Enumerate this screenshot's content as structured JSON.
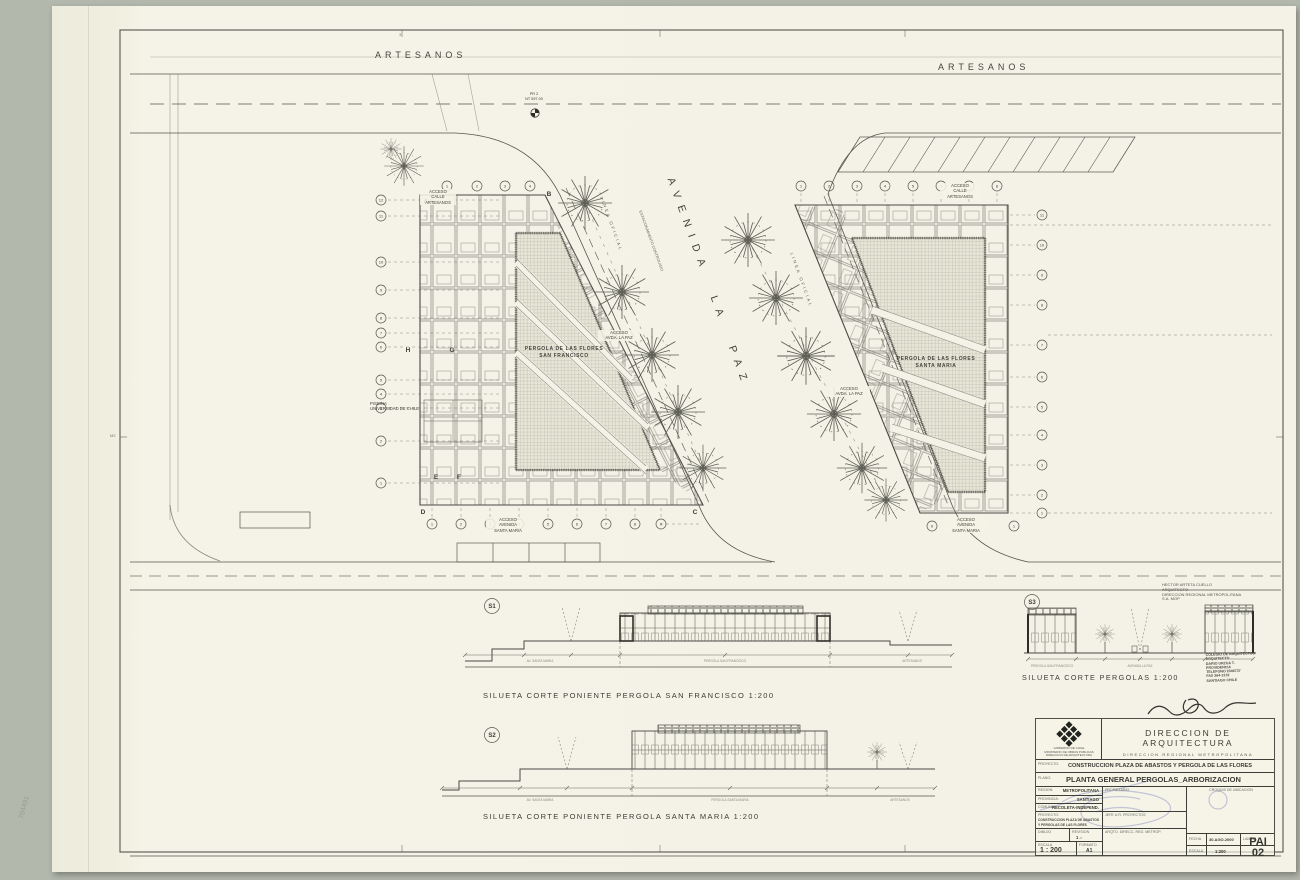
{
  "sheet": {
    "lamina_code": "PAI",
    "lamina_num": "02",
    "fold_mark": "3",
    "margin_mark": "M2",
    "corner_note": "784491"
  },
  "plan": {
    "street_top_left": "ARTESANOS",
    "street_top_right": "ARTESANOS",
    "avenue": "AVENIDA LA PAZ",
    "linea_oficial": "LINEA OFICIAL",
    "parking_note": "ESTACIONAMIENTO CONTROLADO",
    "survey": [
      "PR 2",
      "NT 597.00"
    ],
    "piscina": [
      "PISCINA",
      "UNIVERSIDAD DE CHILE"
    ],
    "left": {
      "name": [
        "PERGOLA DE LAS FLORES",
        "SAN FRANCISCO"
      ],
      "acceso_top": [
        "ACCESO",
        "CALLE",
        "ARTESANOS"
      ],
      "acceso_paz": [
        "ACCESO",
        "AVDA. LA PAZ"
      ],
      "acceso_bottom": [
        "ACCESO",
        "AVENIDA",
        "SANTA MARIA"
      ],
      "grid_letters": [
        "A",
        "B",
        "C",
        "D",
        "E",
        "F",
        "G",
        "H"
      ],
      "top_axes": [
        "1",
        "2",
        "3",
        "4"
      ],
      "bottom_axes": [
        "1",
        "2",
        "3",
        "4",
        "5",
        "6",
        "7",
        "8",
        "9"
      ],
      "side_axes": [
        "12",
        "11",
        "10",
        "9",
        "8",
        "7",
        "6",
        "5",
        "4",
        "3",
        "2",
        "1"
      ]
    },
    "right": {
      "name": [
        "PERGOLA DE LAS FLORES",
        "SANTA MARIA"
      ],
      "acceso_top": [
        "ACCESO",
        "CALLE",
        "ARTESANOS"
      ],
      "acceso_paz": [
        "ACCESO",
        "AVDA. LA PAZ"
      ],
      "acceso_bottom": [
        "ACCESO",
        "AVENIDA",
        "SANTA MARIA"
      ],
      "top_axes": [
        "1",
        "2",
        "3",
        "4",
        "5",
        "6",
        "7",
        "8"
      ],
      "side_axes": [
        "11",
        "10",
        "9",
        "8",
        "7",
        "6",
        "5",
        "4",
        "3",
        "2",
        "1"
      ],
      "bottom_axes": [
        "9",
        "1"
      ]
    }
  },
  "sections": {
    "s1": {
      "tag": "S1",
      "caption": "SILUETA CORTE PONIENTE PERGOLA SAN FRANCISCO 1:200",
      "labels": [
        "AV. SANTA MARIA",
        "PERGOLA SAN FRANCISCO",
        "ARTESANOS"
      ]
    },
    "s2": {
      "tag": "S2",
      "caption": "SILUETA CORTE PONIENTE PERGOLA SANTA MARIA 1:200",
      "labels": [
        "AV. SANTA MARIA",
        "PERGOLA SANTA MARIA",
        "ARTESANOS"
      ]
    },
    "s3": {
      "tag": "S3",
      "caption": "SILUETA CORTE PERGOLAS 1:200",
      "labels": [
        "PERGOLA SAN FRANCISCO",
        "AVENIDA LA PAZ",
        "PERGOLA SANTA MARIA"
      ]
    }
  },
  "note": [
    "HECTOR ARTETA CUELLO",
    "ARQUITECTO",
    "DIRECCION REGIONAL METROPOLITANA",
    "S.A.        MOP"
  ],
  "stamp": [
    "COLEGIO DE ARQUITECTOS",
    "ARQUITECTO",
    "DARIO URZUA T.",
    "PROVIDENCIA",
    "TELEFONO 2346737",
    "FAX 264-3132",
    "SANTIAGO  CHILE"
  ],
  "titleblock": {
    "org1": "DIRECCION DE ARQUITECTURA",
    "org2": "DIRECCION REGIONAL METROPOLITANA",
    "logo_lines": [
      "GOBIERNO DE CHILE",
      "MINISTERIO DE OBRAS PUBLICAS",
      "DIRECCION DE ARQUITECTURA"
    ],
    "proyecto_label": "PROYECTO:",
    "proyecto_value": "CONSTRUCCION PLAZA DE ABASTOS Y PERGOLA DE LAS FLORES",
    "plano_label": "PLANO:",
    "plano_value": "PLANTA GENERAL PERGOLAS_ARBORIZACION",
    "region_label": "REGION:",
    "region_value": "METROPOLITANA",
    "provincia_label": "PROVINCIA:",
    "provincia_value": "SANTIAGO",
    "comuna_label": "COMUNA:",
    "comuna_value": "RECOLETA-INDEPEND.",
    "propietario_label": "PROPIETARIO",
    "croquis_label": "CROQUIS DE UBICACION",
    "proyecto2_label": "PROYECTO:",
    "proyecto2_value1": "CONSTRUCCION PLAZA DE ABASTOS",
    "proyecto2_value2": "Y PERGOLAS DE LAS FLORES",
    "jefe_label": "JEFE U.R. PROYECTOS",
    "arqto_label": "ARQTO. DIRECC. REG. METROP.",
    "dibujo_label": "DIBUJO",
    "revision_label": "REVISION",
    "revision_value": "1 .-",
    "escala_label": "ESCALA",
    "escala_value": "1 : 200",
    "formato_label": "FORMATO",
    "formato_value": "A1",
    "fecha_label": "FECHA",
    "fecha_value": "30.AGO.2000",
    "lamina_label": "LAMINA",
    "escala2_label": "ESCALA",
    "escala2_value": "1:200"
  }
}
